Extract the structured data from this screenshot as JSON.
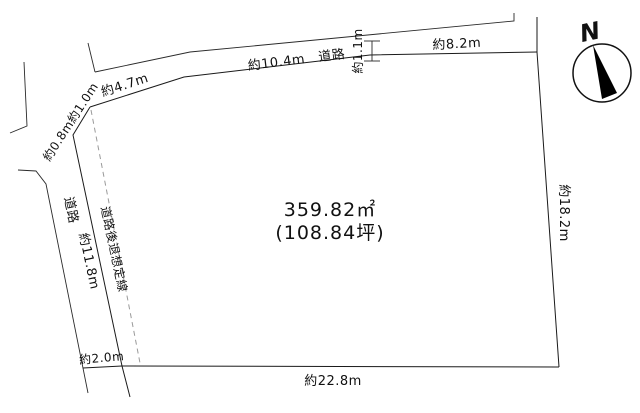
{
  "diagram": {
    "area_m2": "359.82㎡",
    "area_tsubo": "(108.84坪)",
    "compass_label": "N",
    "dimensions": {
      "north_slant": "約4.7m",
      "north_main_with_road": "約10.4m　道路",
      "north_jog_width": "約1.1m",
      "north_east": "約8.2m",
      "east": "約18.2m",
      "south": "約22.8m",
      "west": "約11.8m",
      "northwest_corner": "約0.8m約1.0m",
      "southwest_road_width": "約2.0m"
    },
    "labels": {
      "west_road": "道路",
      "setback_line": "道路後退想定線"
    },
    "colors": {
      "line": "#1a1a1a",
      "setback_line": "#9a9a9a",
      "text": "#111111",
      "background": "#ffffff"
    }
  }
}
